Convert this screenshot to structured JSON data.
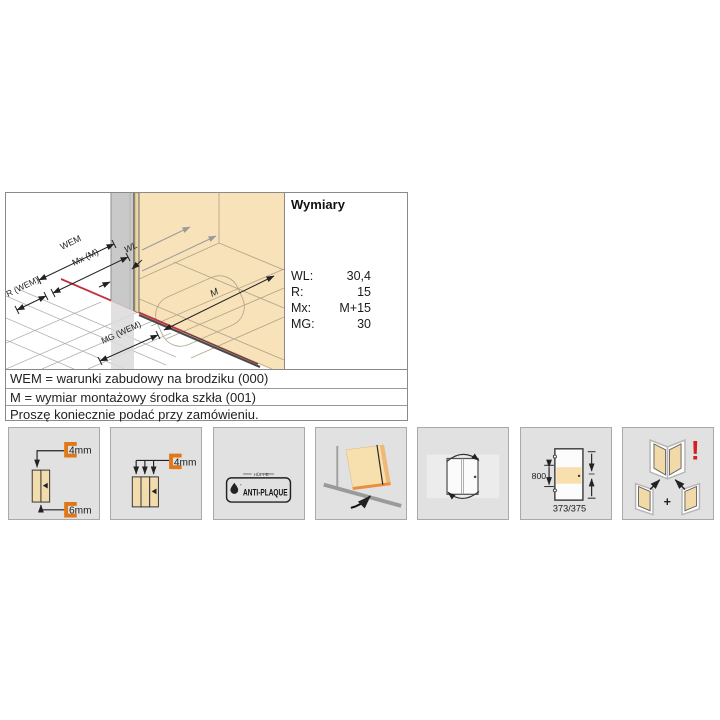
{
  "dimensions_panel": {
    "title": "Wymiary",
    "table": {
      "rows": [
        {
          "label": "WL:",
          "value": "30,4"
        },
        {
          "label": "R:",
          "value": "15"
        },
        {
          "label": "Mx:",
          "value": "M+15"
        },
        {
          "label": "MG:",
          "value": "30"
        }
      ]
    },
    "diagram_labels": {
      "wem": "WEM",
      "mx": "Mx (M)",
      "r": "R (WEM)",
      "wl": "WL",
      "m": "M",
      "mg": "MG (WEM)"
    },
    "notes": [
      "WEM = warunki zabudowy na brodziku (000)",
      "M = wymiar montażowy środka szkła (001)",
      "Proszę koniecznie podać przy zamówieniu."
    ]
  },
  "feature_icons": [
    {
      "name": "glass-thickness-4-6mm-icon",
      "labels": [
        "4mm",
        "6mm"
      ]
    },
    {
      "name": "glass-thickness-triple-4mm-icon",
      "labels": [
        "4mm"
      ]
    },
    {
      "name": "anti-plaque-badge-icon",
      "brand": "HÜPPE",
      "label": "ANTI-PLAQUE"
    },
    {
      "name": "door-swing-over-tray-icon",
      "labels": []
    },
    {
      "name": "door-double-swing-icon",
      "labels": []
    },
    {
      "name": "entry-dimensions-icon",
      "labels": [
        "800",
        "373/375"
      ]
    },
    {
      "name": "corner-combination-icon",
      "labels": [
        "+",
        "!"
      ]
    }
  ],
  "colors": {
    "accent_orange": "#e07818",
    "glass_beige": "#f8e2ba",
    "alert_red": "#d42020",
    "dimension_red": "#c13038"
  }
}
